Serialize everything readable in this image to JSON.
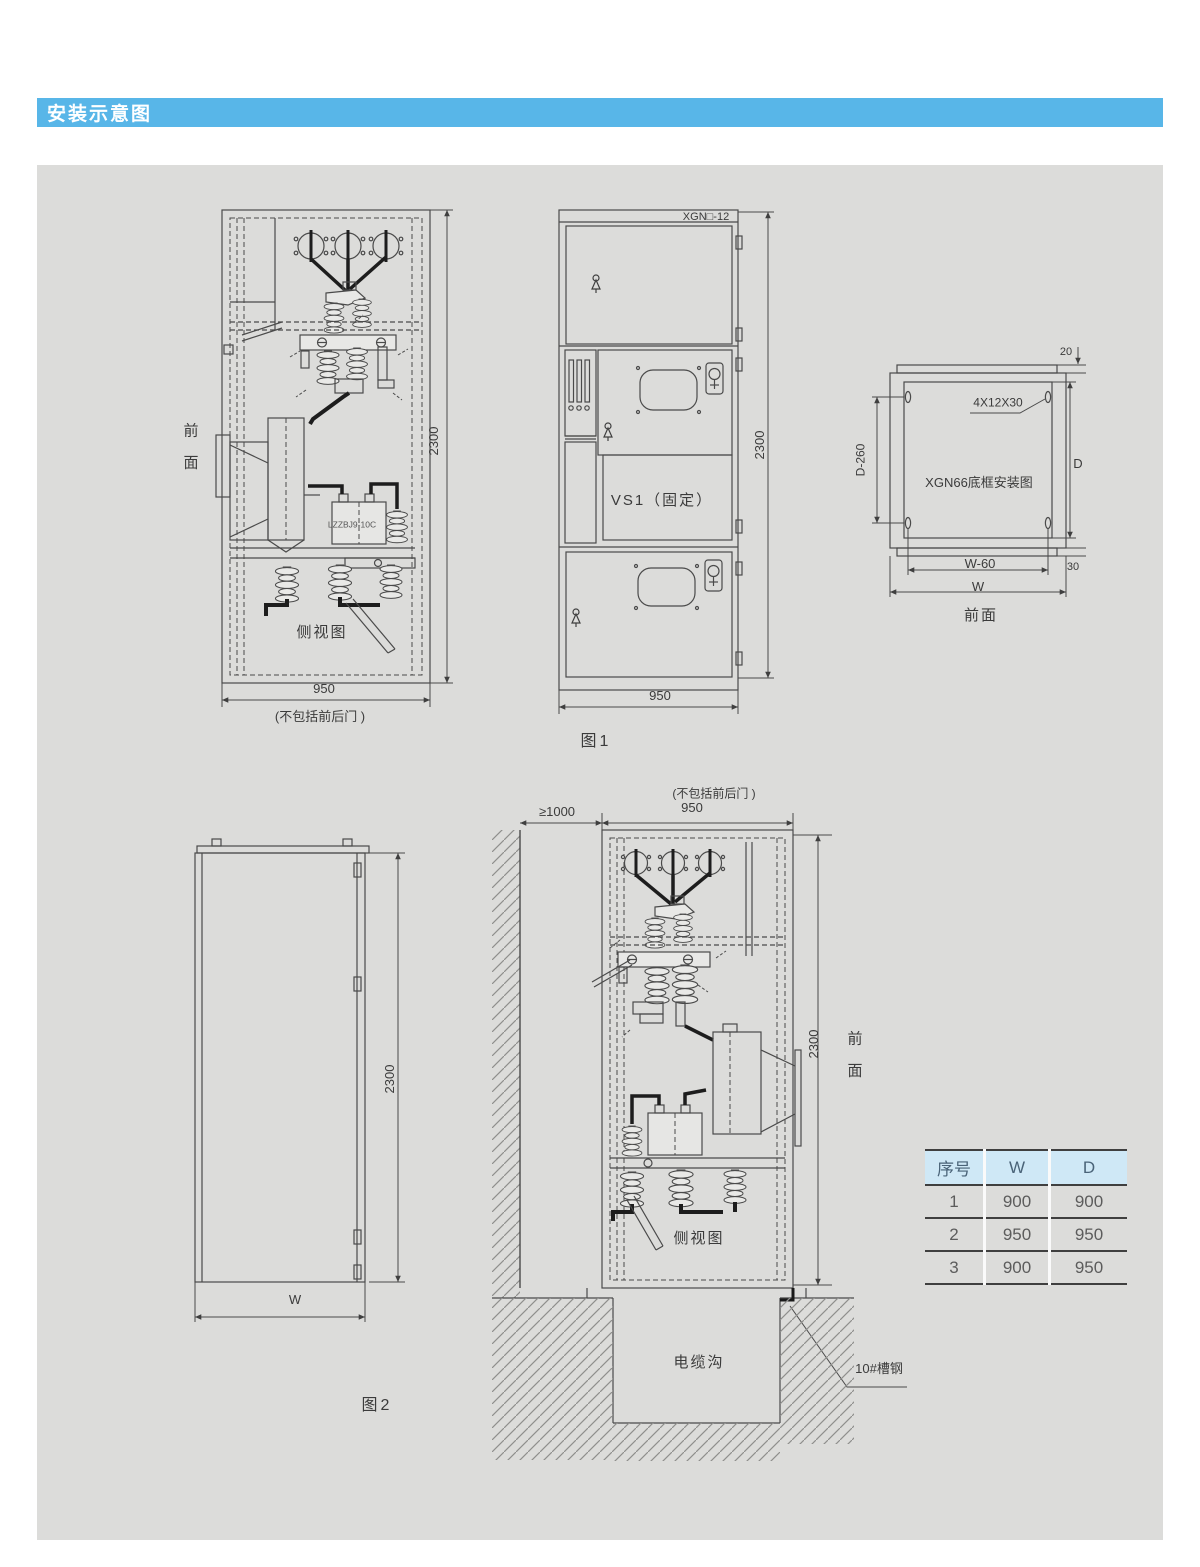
{
  "header": {
    "title": "安装示意图"
  },
  "fig1": {
    "caption": "图1",
    "side": {
      "front_label": "前\n面",
      "height": "2300",
      "width": "950",
      "width_note": "(不包括前后门 )",
      "ct_label": "LZZBJ9-10C",
      "view_label": "侧视图"
    },
    "front": {
      "model": "XGN□-12",
      "breaker": "VS1（固定）",
      "height": "2300",
      "width": "950"
    },
    "frame": {
      "title": "XGN66底框安装图",
      "hole_spec": "4X12X30",
      "top_gap": "20",
      "bottom_gap": "30",
      "depth": "D",
      "depth_span": "D-260",
      "width_span": "W-60",
      "width": "W",
      "front_label": "前面"
    }
  },
  "fig2": {
    "caption": "图2",
    "left": {
      "height": "2300",
      "width": "W"
    },
    "middle": {
      "wall_gap": "≥1000",
      "width": "950",
      "width_note": "(不包括前后门 )",
      "height": "2300",
      "front_label": "前\n面",
      "view_label": "侧视图",
      "trench_label": "电缆沟",
      "channel_label": "10#槽钢"
    }
  },
  "table": {
    "headers": [
      "序号",
      "W",
      "D"
    ],
    "rows": [
      [
        "1",
        "900",
        "900"
      ],
      [
        "2",
        "950",
        "950"
      ],
      [
        "3",
        "900",
        "950"
      ]
    ]
  }
}
